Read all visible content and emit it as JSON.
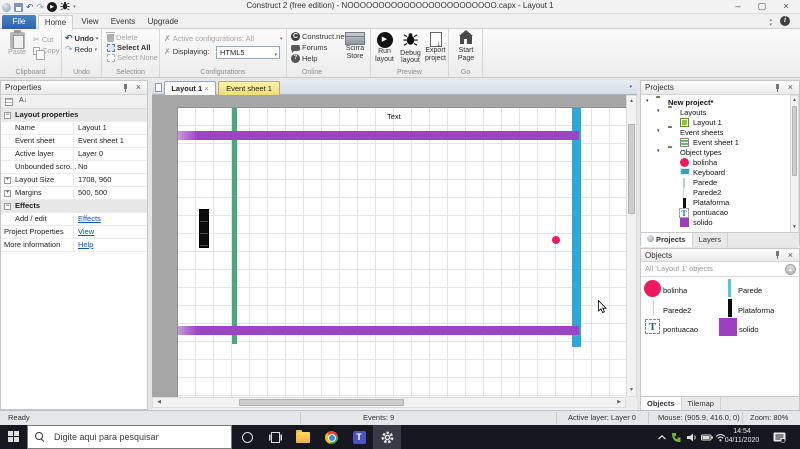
{
  "window": {
    "title": "Construct 2 (free edition) - NOOOOOOOOOOOOOOOOOOOOOOOO.capx - Layout 1"
  },
  "ribbon": {
    "tabs": [
      "File",
      "Home",
      "View",
      "Events",
      "Upgrade"
    ],
    "clipboard": {
      "label": "Clipboard",
      "paste": "Paste",
      "cut": "Cut",
      "copy": "Copy"
    },
    "undo": {
      "label": "Undo",
      "undo": "Undo",
      "redo": "Redo"
    },
    "selection": {
      "label": "Selection",
      "delete": "Delete",
      "select_all": "Select All",
      "select_none": "Select None"
    },
    "configurations": {
      "label": "Configurations",
      "active_configurations": "Active configurations: All",
      "displaying": "Displaying:",
      "displaying_value": "HTML5"
    },
    "online": {
      "label": "Online",
      "construct": "Construct.net",
      "forums": "Forums",
      "help": "Help",
      "store": "Scirra Store"
    },
    "preview": {
      "label": "Preview",
      "run": "Run layout",
      "debug": "Debug layout",
      "export": "Export project"
    },
    "go": {
      "label": "Go",
      "start_page": "Start Page"
    }
  },
  "properties": {
    "title": "Properties",
    "rows": [
      {
        "label": "Layout properties"
      },
      {
        "label": "Name",
        "value": "Layout 1"
      },
      {
        "label": "Event sheet",
        "value": "Event sheet 1"
      },
      {
        "label": "Active layer",
        "value": "Layer 0"
      },
      {
        "label": "Unbounded scro...",
        "value": "No"
      },
      {
        "label": "Layout Size",
        "value": "1708, 960"
      },
      {
        "label": "Margins",
        "value": "500, 500"
      },
      {
        "label": "Effects"
      },
      {
        "label": "Add / edit",
        "value": "Effects"
      },
      {
        "label": "Project Properties",
        "value": "View"
      },
      {
        "label": "More information",
        "value": "Help"
      }
    ]
  },
  "canvas": {
    "tabs": [
      "Layout 1",
      "Event sheet 1"
    ],
    "text_object": "Text"
  },
  "projects": {
    "title": "Projects",
    "tree": [
      {
        "label": "New project*"
      },
      {
        "label": "Layouts"
      },
      {
        "label": "Layout 1"
      },
      {
        "label": "Event sheets"
      },
      {
        "label": "Event sheet 1"
      },
      {
        "label": "Object types"
      },
      {
        "label": "bolinha"
      },
      {
        "label": "Keyboard"
      },
      {
        "label": "Parede"
      },
      {
        "label": "Parede2"
      },
      {
        "label": "Plataforma"
      },
      {
        "label": "pontuacao"
      },
      {
        "label": "solido"
      }
    ],
    "tabs": [
      "Projects",
      "Layers"
    ]
  },
  "objects": {
    "title": "Objects",
    "filter": "All 'Layout 1' objects",
    "items": [
      "bolinha",
      "Parede",
      "Parede2",
      "Plataforma",
      "pontuacao",
      "solido"
    ],
    "tabs": [
      "Objects",
      "Tilemap"
    ]
  },
  "status_bar": {
    "ready": "Ready",
    "events": "Events: 9",
    "active_layer": "Active layer: Layer 0",
    "mouse": "Mouse: (905.9, 416.0, 0)",
    "zoom": "Zoom: 80%"
  },
  "taskbar": {
    "search_placeholder": "Digite aqui para pesquisar",
    "clock_time": "14:54",
    "clock_date": "04/11/2020"
  },
  "colors": {
    "purple": "#9d43c5",
    "green": "#4ea67a",
    "cyan": "#2ea7da",
    "pink": "#ee1a60",
    "tab_yellow": "#f0dc74",
    "file_tab_blue": "#2e62a8"
  }
}
